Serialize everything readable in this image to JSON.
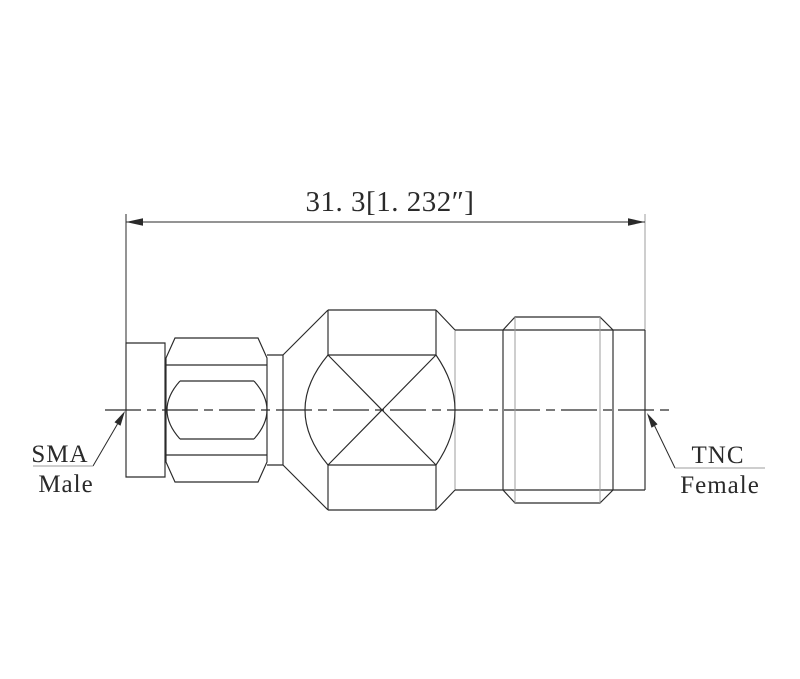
{
  "colors": {
    "background": "#ffffff",
    "line": "#2a2a2a",
    "gray_line": "#9c9c9c"
  },
  "dimension": {
    "text": "31. 3[1. 232″]"
  },
  "labels": {
    "sma": {
      "line1": "SMA",
      "line2": "Male"
    },
    "tnc": {
      "line1": "TNC",
      "line2": "Female"
    }
  }
}
